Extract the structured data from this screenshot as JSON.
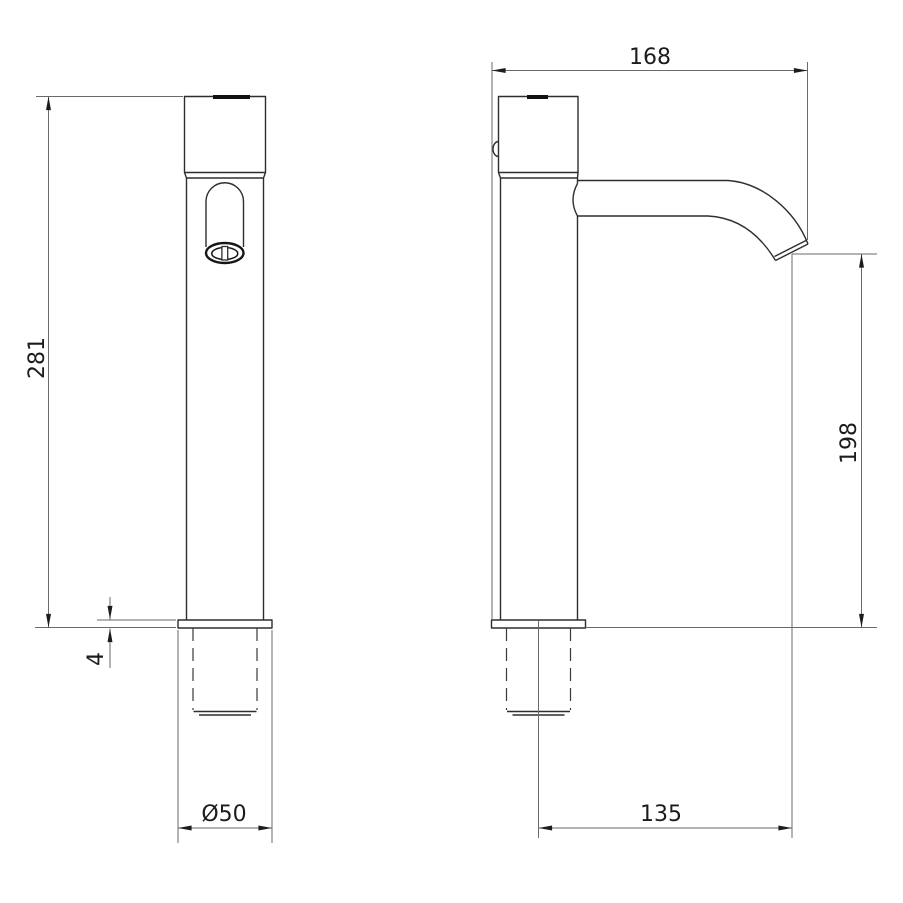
{
  "drawing": {
    "kind": "technical dimension drawing",
    "subject": "tall single-lever basin tap, front view and side view",
    "views": [
      {
        "id": "front",
        "dimensions": [
          {
            "name": "overall height (mm)",
            "label": "281"
          },
          {
            "name": "base plate thickness (mm)",
            "label": "4"
          },
          {
            "name": "base diameter (mm)",
            "label": "Ø50"
          }
        ]
      },
      {
        "id": "side",
        "dimensions": [
          {
            "name": "overall depth (mm)",
            "label": "168"
          },
          {
            "name": "spout outlet height above deck (mm)",
            "label": "198"
          },
          {
            "name": "spout reach from axis (mm)",
            "label": "135"
          }
        ]
      }
    ],
    "colors": {
      "background": "#ffffff",
      "object_line": "#2e2e2e",
      "dimension_line": "#6a6a6a",
      "text": "#1c1c1c"
    }
  }
}
